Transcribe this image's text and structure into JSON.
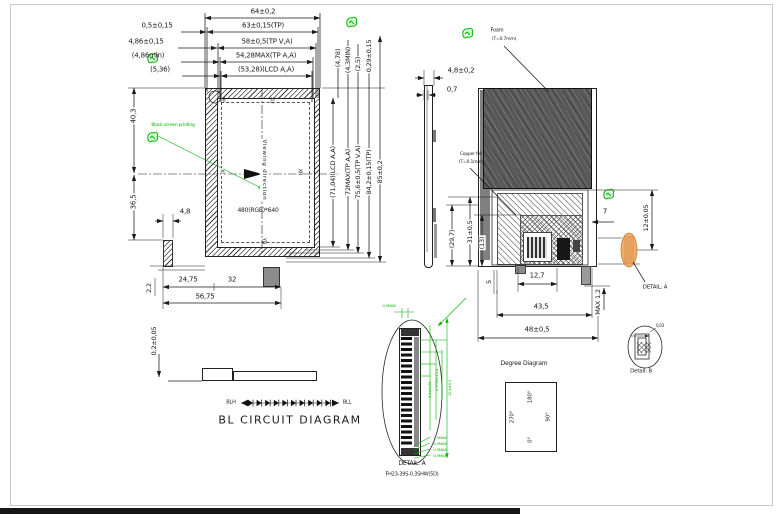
{
  "front_view": {
    "dims_top": [
      "64±0,2",
      "63±0,15(TP)",
      "58±0,5(TP V,A)",
      "54,28MAX(TP A,A)",
      "(53,28)(LCD A,A)"
    ],
    "dims_top_left": [
      "0,5±0,15",
      "4,86±0,15",
      "(4,86min)",
      "(5,36)"
    ],
    "dims_right_top": [
      "(4,78)",
      "(4,3MIN)",
      "(2,5)",
      "0,29±0,15"
    ],
    "dims_right": [
      "(71,04)(LCD A,A)",
      "72MAX(TP A,A)",
      "75,6±0,5(TP V,A)",
      "84,2±0,15(TP)",
      "85±0,2"
    ],
    "dims_left": [
      "40,3",
      "36,5"
    ],
    "dims_bottom": [
      "4,8",
      "2,2",
      "24,75",
      "32",
      "56,75"
    ],
    "detail_marker": "B",
    "screen": {
      "viewing_direction": "Viewing direction",
      "resolution": "480(RGB)*640",
      "top": "XU",
      "left": "XL",
      "right": "XR",
      "bottom": "YD"
    },
    "note": "Black screen printing"
  },
  "side_view": {
    "width": "4,8±0,2",
    "glass": "0,7"
  },
  "back_view": {
    "foam_label": "Foam",
    "foam_thickness": "(T=0.7mm)",
    "copper_label": "Copper foil",
    "copper_thickness": "(T=0.1mm)",
    "dim_29_7": "(29,7)",
    "dim_31": "31±0,5",
    "dim_13": "(13)",
    "dim_7": "7",
    "dim_12": "12±0,05",
    "dim_12_7": "12,7",
    "dim_5": "5",
    "dim_43_5": "43,5",
    "dim_48": "48±0,5",
    "dim_max": "MAX 1,2",
    "detail_ref": "DETAIL: A"
  },
  "detail_a": {
    "title": "DETAIL: A",
    "part_no": "FH23-39S-0.3SHW(5D)",
    "dim_top": "0,3MAX",
    "pin_dims": [
      "0,3MAX",
      "0,3MAX",
      "0,3MAX",
      "0,3MAX"
    ],
    "side_dims": [
      "0,3±0,03",
      "0,3*38=11,4",
      "12,4±0,1"
    ]
  },
  "bl_circuit": {
    "title": "BL CIRCUIT DIAGRAM",
    "anode": "BLH",
    "cathode": "BLL",
    "dim_thickness": "0,2±0,05"
  },
  "degree_diagram": {
    "title": "Degree Diagram",
    "top": "180°",
    "left": "270°",
    "right": "90°",
    "bottom": "0°"
  },
  "detail_b": {
    "title": "Detail: B",
    "dim": "0,03"
  }
}
